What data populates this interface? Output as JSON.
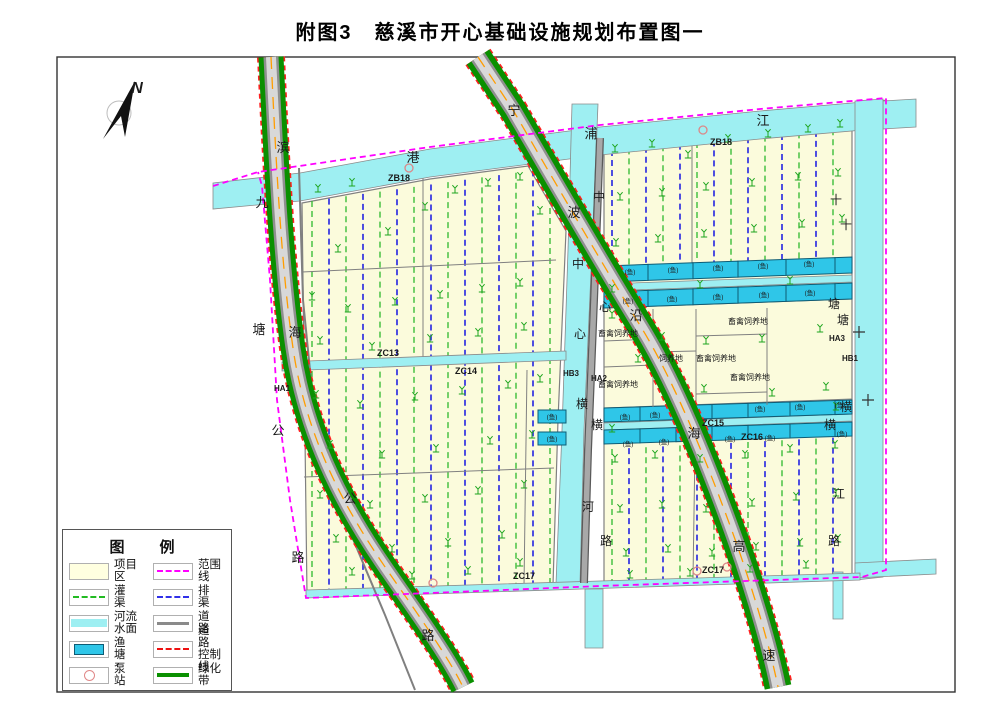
{
  "title": "附图3　慈溪市开心基础设施规划布置图一",
  "colors": {
    "field": "#FBFBDC",
    "river": "#9EEFF2",
    "pond": "#2FC6E8",
    "green_belt": "#0a9000",
    "road_gray": "#8f8f8f",
    "center_line_orange": "#ff9d00",
    "boundary_magenta": "#FF00FF",
    "control_red": "#ff2020",
    "irrigation": "#2db82d",
    "drainage": "#2f2fe0",
    "structure_gray": "#808080"
  },
  "legend": {
    "title": "图　例",
    "left": [
      {
        "sym": "project",
        "label": "项目区"
      },
      {
        "sym": "irrigation",
        "label": "灌　渠"
      },
      {
        "sym": "river",
        "label": "河流水面"
      },
      {
        "sym": "pond",
        "label": "渔　塘"
      },
      {
        "sym": "pump",
        "label": "泵　站"
      }
    ],
    "right": [
      {
        "sym": "range",
        "label": "范围线"
      },
      {
        "sym": "drain",
        "label": "排　渠"
      },
      {
        "sym": "road",
        "label": "道　路"
      },
      {
        "sym": "control",
        "label": "道　路\n控制线"
      },
      {
        "sym": "green",
        "label": "绿化带"
      }
    ]
  },
  "map": {
    "labels": [
      {
        "t": "N",
        "x": 137,
        "y": 93,
        "s": 16,
        "b": 1,
        "i": 1,
        "n": "north-label"
      },
      {
        "t": "滨",
        "x": 283,
        "y": 152,
        "s": 13,
        "n": "road-binhai"
      },
      {
        "t": "海",
        "x": 295,
        "y": 337,
        "s": 13,
        "n": "road-binhai"
      },
      {
        "t": "公",
        "x": 350,
        "y": 503,
        "s": 13,
        "n": "road-binhai"
      },
      {
        "t": "路",
        "x": 428,
        "y": 640,
        "s": 13,
        "n": "road-binhai"
      },
      {
        "t": "九",
        "x": 262,
        "y": 207,
        "s": 13,
        "n": "road-jiutang"
      },
      {
        "t": "塘",
        "x": 259,
        "y": 334,
        "s": 13,
        "n": "road-jiutang"
      },
      {
        "t": "公",
        "x": 278,
        "y": 435,
        "s": 13,
        "n": "road-jiutang"
      },
      {
        "t": "路",
        "x": 298,
        "y": 562,
        "s": 13,
        "n": "road-jiutang"
      },
      {
        "t": "宁",
        "x": 514,
        "y": 115,
        "s": 13,
        "n": "road-ningbo-expwy"
      },
      {
        "t": "波",
        "x": 574,
        "y": 217,
        "s": 13,
        "n": "road-ningbo-expwy"
      },
      {
        "t": "沿",
        "x": 636,
        "y": 320,
        "s": 13,
        "n": "road-ningbo-expwy"
      },
      {
        "t": "海",
        "x": 694,
        "y": 438,
        "s": 13,
        "n": "road-ningbo-expwy"
      },
      {
        "t": "高",
        "x": 739,
        "y": 551,
        "s": 13,
        "n": "road-ningbo-expwy"
      },
      {
        "t": "速",
        "x": 769,
        "y": 660,
        "s": 13,
        "n": "road-ningbo-expwy"
      },
      {
        "t": "港",
        "x": 413,
        "y": 162,
        "s": 13,
        "n": "river-top"
      },
      {
        "t": "浦",
        "x": 591,
        "y": 138,
        "s": 13,
        "n": "river-top"
      },
      {
        "t": "江",
        "x": 763,
        "y": 125,
        "s": 13,
        "n": "river-top"
      },
      {
        "t": "中",
        "x": 599,
        "y": 201,
        "s": 12,
        "n": "road-center"
      },
      {
        "t": "心",
        "x": 605,
        "y": 311,
        "s": 12,
        "n": "road-center"
      },
      {
        "t": "横",
        "x": 597,
        "y": 429,
        "s": 12,
        "n": "road-center"
      },
      {
        "t": "路",
        "x": 606,
        "y": 545,
        "s": 12,
        "n": "road-center"
      },
      {
        "t": "中",
        "x": 578,
        "y": 268,
        "s": 12,
        "n": "river-center"
      },
      {
        "t": "心",
        "x": 580,
        "y": 338,
        "s": 12,
        "n": "river-center"
      },
      {
        "t": "横",
        "x": 582,
        "y": 408,
        "s": 12,
        "n": "river-center"
      },
      {
        "t": "河",
        "x": 588,
        "y": 511,
        "s": 12,
        "n": "river-center"
      },
      {
        "t": "十",
        "x": 846,
        "y": 229,
        "s": 12,
        "n": "river-right"
      },
      {
        "t": "塘",
        "x": 843,
        "y": 324,
        "s": 12,
        "n": "river-right"
      },
      {
        "t": "横",
        "x": 846,
        "y": 411,
        "s": 12,
        "n": "river-right"
      },
      {
        "t": "江",
        "x": 839,
        "y": 498,
        "s": 12,
        "n": "river-right"
      },
      {
        "t": "十",
        "x": 836,
        "y": 204,
        "s": 12,
        "n": "road-right"
      },
      {
        "t": "塘",
        "x": 834,
        "y": 308,
        "s": 12,
        "n": "road-right"
      },
      {
        "t": "横",
        "x": 830,
        "y": 429,
        "s": 12,
        "n": "road-right"
      },
      {
        "t": "路",
        "x": 834,
        "y": 545,
        "s": 12,
        "n": "road-right"
      },
      {
        "t": "ZB18",
        "x": 399,
        "y": 181,
        "s": 9,
        "b": 1,
        "n": "zone-code"
      },
      {
        "t": "ZB18",
        "x": 721,
        "y": 145,
        "s": 9,
        "b": 1,
        "n": "zone-code"
      },
      {
        "t": "ZC13",
        "x": 388,
        "y": 356,
        "s": 9,
        "b": 1,
        "n": "zone-code"
      },
      {
        "t": "ZC14",
        "x": 466,
        "y": 374,
        "s": 9,
        "b": 1,
        "n": "zone-code"
      },
      {
        "t": "ZC15",
        "x": 713,
        "y": 426,
        "s": 9,
        "b": 1,
        "n": "zone-code"
      },
      {
        "t": "ZC16",
        "x": 752,
        "y": 440,
        "s": 9,
        "b": 1,
        "n": "zone-code"
      },
      {
        "t": "ZC17",
        "x": 524,
        "y": 579,
        "s": 9,
        "b": 1,
        "n": "zone-code"
      },
      {
        "t": "ZC17",
        "x": 713,
        "y": 573,
        "s": 9,
        "b": 1,
        "n": "zone-code"
      },
      {
        "t": "HA1",
        "x": 282,
        "y": 391,
        "s": 8,
        "b": 1,
        "n": "zone-code"
      },
      {
        "t": "HA2",
        "x": 599,
        "y": 381,
        "s": 8,
        "b": 1,
        "n": "zone-code"
      },
      {
        "t": "HB3",
        "x": 571,
        "y": 376,
        "s": 8,
        "b": 1,
        "n": "zone-code"
      },
      {
        "t": "HA3",
        "x": 837,
        "y": 341,
        "s": 8,
        "b": 1,
        "n": "zone-code"
      },
      {
        "t": "HB1",
        "x": 850,
        "y": 361,
        "s": 8,
        "b": 1,
        "n": "zone-code"
      },
      {
        "t": "畜禽饲养地",
        "x": 618,
        "y": 336,
        "s": 8,
        "n": "livestock-label"
      },
      {
        "t": "畜禽饲养地",
        "x": 748,
        "y": 324,
        "s": 8,
        "n": "livestock-label"
      },
      {
        "t": "畜禽饲养地",
        "x": 716,
        "y": 361,
        "s": 8,
        "n": "livestock-label"
      },
      {
        "t": "畜禽饲养地",
        "x": 618,
        "y": 387,
        "s": 8,
        "n": "livestock-label"
      },
      {
        "t": "畜禽饲养地",
        "x": 750,
        "y": 380,
        "s": 8,
        "n": "livestock-label"
      },
      {
        "t": "饲养地",
        "x": 671,
        "y": 361,
        "s": 8,
        "n": "livestock-label"
      },
      {
        "t": "(鱼)",
        "x": 630,
        "y": 274,
        "s": 6.5,
        "n": "fish-label"
      },
      {
        "t": "(鱼)",
        "x": 673,
        "y": 272,
        "s": 6.5,
        "n": "fish-label"
      },
      {
        "t": "(鱼)",
        "x": 718,
        "y": 270,
        "s": 6.5,
        "n": "fish-label"
      },
      {
        "t": "(鱼)",
        "x": 763,
        "y": 268,
        "s": 6.5,
        "n": "fish-label"
      },
      {
        "t": "(鱼)",
        "x": 809,
        "y": 266,
        "s": 6.5,
        "n": "fish-label"
      },
      {
        "t": "(鱼)",
        "x": 628,
        "y": 303,
        "s": 6.5,
        "n": "fish-label"
      },
      {
        "t": "(鱼)",
        "x": 672,
        "y": 301,
        "s": 6.5,
        "n": "fish-label"
      },
      {
        "t": "(鱼)",
        "x": 718,
        "y": 299,
        "s": 6.5,
        "n": "fish-label"
      },
      {
        "t": "(鱼)",
        "x": 764,
        "y": 297,
        "s": 6.5,
        "n": "fish-label"
      },
      {
        "t": "(鱼)",
        "x": 810,
        "y": 295,
        "s": 6.5,
        "n": "fish-label"
      },
      {
        "t": "(鱼)",
        "x": 625,
        "y": 419,
        "s": 6.5,
        "n": "fish-label"
      },
      {
        "t": "(鱼)",
        "x": 655,
        "y": 417,
        "s": 6.5,
        "n": "fish-label"
      },
      {
        "t": "(鱼)",
        "x": 760,
        "y": 411,
        "s": 6.5,
        "n": "fish-label"
      },
      {
        "t": "(鱼)",
        "x": 800,
        "y": 409,
        "s": 6.5,
        "n": "fish-label"
      },
      {
        "t": "(鱼)",
        "x": 840,
        "y": 407,
        "s": 6.5,
        "n": "fish-label"
      },
      {
        "t": "(鱼)",
        "x": 628,
        "y": 446,
        "s": 6.5,
        "n": "fish-label"
      },
      {
        "t": "(鱼)",
        "x": 664,
        "y": 444,
        "s": 6.5,
        "n": "fish-label"
      },
      {
        "t": "(鱼)",
        "x": 730,
        "y": 441,
        "s": 6.5,
        "n": "fish-label"
      },
      {
        "t": "(鱼)",
        "x": 770,
        "y": 440,
        "s": 6.5,
        "n": "fish-label"
      },
      {
        "t": "(鱼)",
        "x": 842,
        "y": 436,
        "s": 6.5,
        "n": "fish-label"
      },
      {
        "t": "(鱼)",
        "x": 552,
        "y": 419,
        "s": 6.5,
        "n": "fish-label"
      },
      {
        "t": "(鱼)",
        "x": 552,
        "y": 441,
        "s": 6.5,
        "n": "fish-label"
      }
    ],
    "grids": [
      {
        "x0": 312,
        "x1": 550,
        "step": 17,
        "top": [
          201,
          168
        ],
        "bot": [
          594,
          585
        ],
        "start": "g"
      },
      {
        "x0": 612,
        "x1": 846,
        "step": 17,
        "top": [
          150,
          128
        ],
        "bot": [
          265,
          257
        ],
        "start": "b"
      },
      {
        "x0": 612,
        "x1": 846,
        "step": 17,
        "top": [
          449,
          437
        ],
        "bot": [
          585,
          576
        ],
        "start": "g"
      }
    ],
    "pond_rows": [
      {
        "x0": 604,
        "x1": 852,
        "y": [
          266,
          257
        ],
        "h": 16,
        "cuts": [
          604,
          648,
          693,
          738,
          786,
          835,
          852
        ]
      },
      {
        "x0": 604,
        "x1": 852,
        "y": [
          292,
          283
        ],
        "h": 16,
        "cuts": [
          604,
          648,
          693,
          738,
          786,
          835,
          852
        ]
      },
      {
        "x0": 604,
        "x1": 852,
        "y": [
          408,
          400
        ],
        "h": 14,
        "cuts": [
          604,
          640,
          676,
          712,
          748,
          790,
          835,
          852
        ]
      },
      {
        "x0": 604,
        "x1": 852,
        "y": [
          430,
          422
        ],
        "h": 14,
        "cuts": [
          604,
          640,
          676,
          712,
          748,
          790,
          835,
          852
        ]
      }
    ],
    "pond_cells_extra": [
      [
        538,
        410,
        28,
        13
      ],
      [
        538,
        432,
        28,
        13
      ]
    ],
    "pumps": [
      [
        409,
        168
      ],
      [
        703,
        130
      ],
      [
        433,
        583
      ],
      [
        697,
        571
      ],
      [
        727,
        567
      ]
    ],
    "trees": [
      [
        318,
        192
      ],
      [
        352,
        186
      ],
      [
        388,
        235
      ],
      [
        338,
        252
      ],
      [
        425,
        210
      ],
      [
        455,
        193
      ],
      [
        488,
        186
      ],
      [
        520,
        180
      ],
      [
        540,
        214
      ],
      [
        312,
        300
      ],
      [
        348,
        312
      ],
      [
        395,
        305
      ],
      [
        440,
        298
      ],
      [
        482,
        292
      ],
      [
        520,
        286
      ],
      [
        320,
        344
      ],
      [
        372,
        350
      ],
      [
        430,
        342
      ],
      [
        478,
        336
      ],
      [
        524,
        330
      ],
      [
        316,
        398
      ],
      [
        360,
        408
      ],
      [
        415,
        400
      ],
      [
        462,
        394
      ],
      [
        508,
        388
      ],
      [
        540,
        382
      ],
      [
        330,
        448
      ],
      [
        382,
        458
      ],
      [
        436,
        452
      ],
      [
        490,
        444
      ],
      [
        532,
        438
      ],
      [
        320,
        498
      ],
      [
        370,
        508
      ],
      [
        425,
        502
      ],
      [
        478,
        494
      ],
      [
        524,
        488
      ],
      [
        336,
        542
      ],
      [
        392,
        552
      ],
      [
        448,
        546
      ],
      [
        502,
        538
      ],
      [
        352,
        575
      ],
      [
        412,
        579
      ],
      [
        468,
        574
      ],
      [
        520,
        566
      ],
      [
        615,
        152
      ],
      [
        652,
        147
      ],
      [
        688,
        158
      ],
      [
        728,
        142
      ],
      [
        768,
        137
      ],
      [
        808,
        132
      ],
      [
        840,
        127
      ],
      [
        620,
        200
      ],
      [
        662,
        196
      ],
      [
        706,
        190
      ],
      [
        752,
        186
      ],
      [
        798,
        180
      ],
      [
        838,
        176
      ],
      [
        616,
        246
      ],
      [
        658,
        242
      ],
      [
        704,
        237
      ],
      [
        754,
        232
      ],
      [
        802,
        227
      ],
      [
        842,
        222
      ],
      [
        612,
        318
      ],
      [
        638,
        362
      ],
      [
        662,
        340
      ],
      [
        706,
        344
      ],
      [
        762,
        342
      ],
      [
        820,
        332
      ],
      [
        704,
        392
      ],
      [
        772,
        396
      ],
      [
        826,
        390
      ],
      [
        612,
        292
      ],
      [
        700,
        288
      ],
      [
        790,
        284
      ],
      [
        612,
        432
      ],
      [
        836,
        410
      ],
      [
        615,
        462
      ],
      [
        655,
        458
      ],
      [
        700,
        462
      ],
      [
        745,
        458
      ],
      [
        790,
        452
      ],
      [
        835,
        448
      ],
      [
        620,
        512
      ],
      [
        662,
        508
      ],
      [
        706,
        512
      ],
      [
        752,
        506
      ],
      [
        796,
        500
      ],
      [
        836,
        496
      ],
      [
        626,
        556
      ],
      [
        668,
        552
      ],
      [
        712,
        556
      ],
      [
        756,
        550
      ],
      [
        800,
        546
      ],
      [
        838,
        542
      ],
      [
        630,
        578
      ],
      [
        690,
        576
      ],
      [
        750,
        572
      ],
      [
        806,
        568
      ]
    ]
  }
}
